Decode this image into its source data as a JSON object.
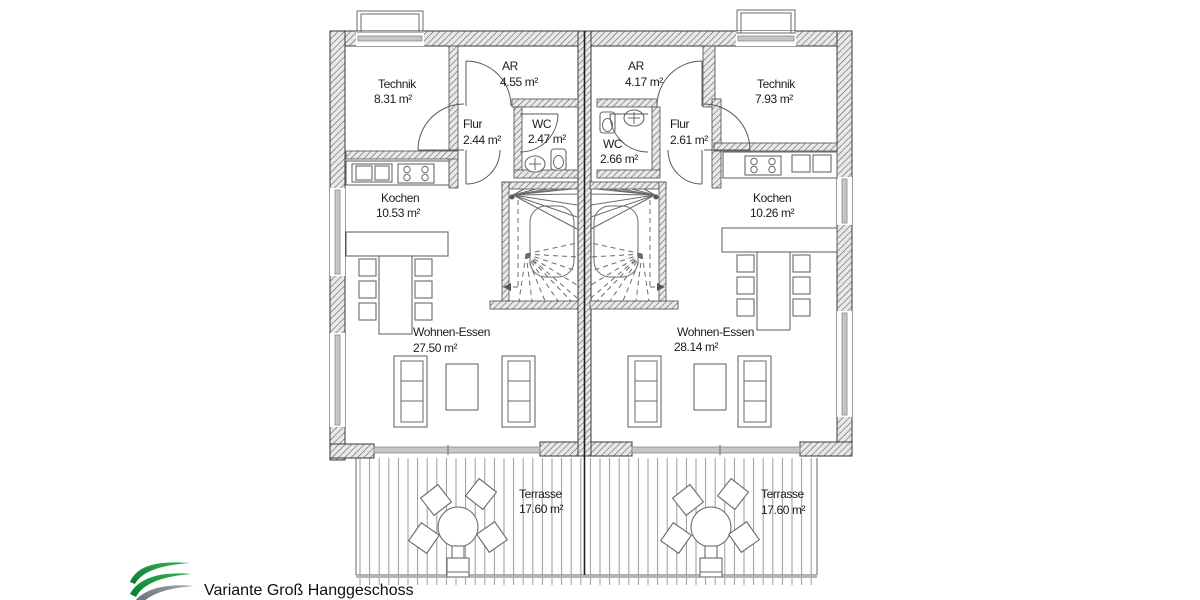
{
  "plan": {
    "left_unit": {
      "technik": {
        "label": "Technik",
        "area": "8.31 m²"
      },
      "ar": {
        "label": "AR",
        "area": "4.55 m²"
      },
      "flur": {
        "label": "Flur",
        "area": "2.44 m²"
      },
      "wc": {
        "label": "WC",
        "area": "2.47 m²"
      },
      "kochen": {
        "label": "Kochen",
        "area": "10.53 m²"
      },
      "wohnen_essen": {
        "label": "Wohnen-Essen",
        "area": "27.50 m²"
      },
      "terrasse": {
        "label": "Terrasse",
        "area": "17.60 m²"
      }
    },
    "right_unit": {
      "technik": {
        "label": "Technik",
        "area": "7.93 m²"
      },
      "ar": {
        "label": "AR",
        "area": "4.17 m²"
      },
      "flur": {
        "label": "Flur",
        "area": "2.61 m²"
      },
      "wc": {
        "label": "WC",
        "area": "2.66 m²"
      },
      "kochen": {
        "label": "Kochen",
        "area": "10.26 m²"
      },
      "wohnen_essen": {
        "label": "Wohnen-Essen",
        "area": "28.14 m²"
      },
      "terrasse": {
        "label": "Terrasse",
        "area": "17.60 m²"
      }
    }
  },
  "footer": {
    "variant_title": "Variante Groß Hanggeschoss"
  },
  "colors": {
    "logo_green_dark": "#0b7c30",
    "logo_green": "#35b24f",
    "logo_gray": "#7d838a",
    "wall_line": "#3a3a3a"
  }
}
